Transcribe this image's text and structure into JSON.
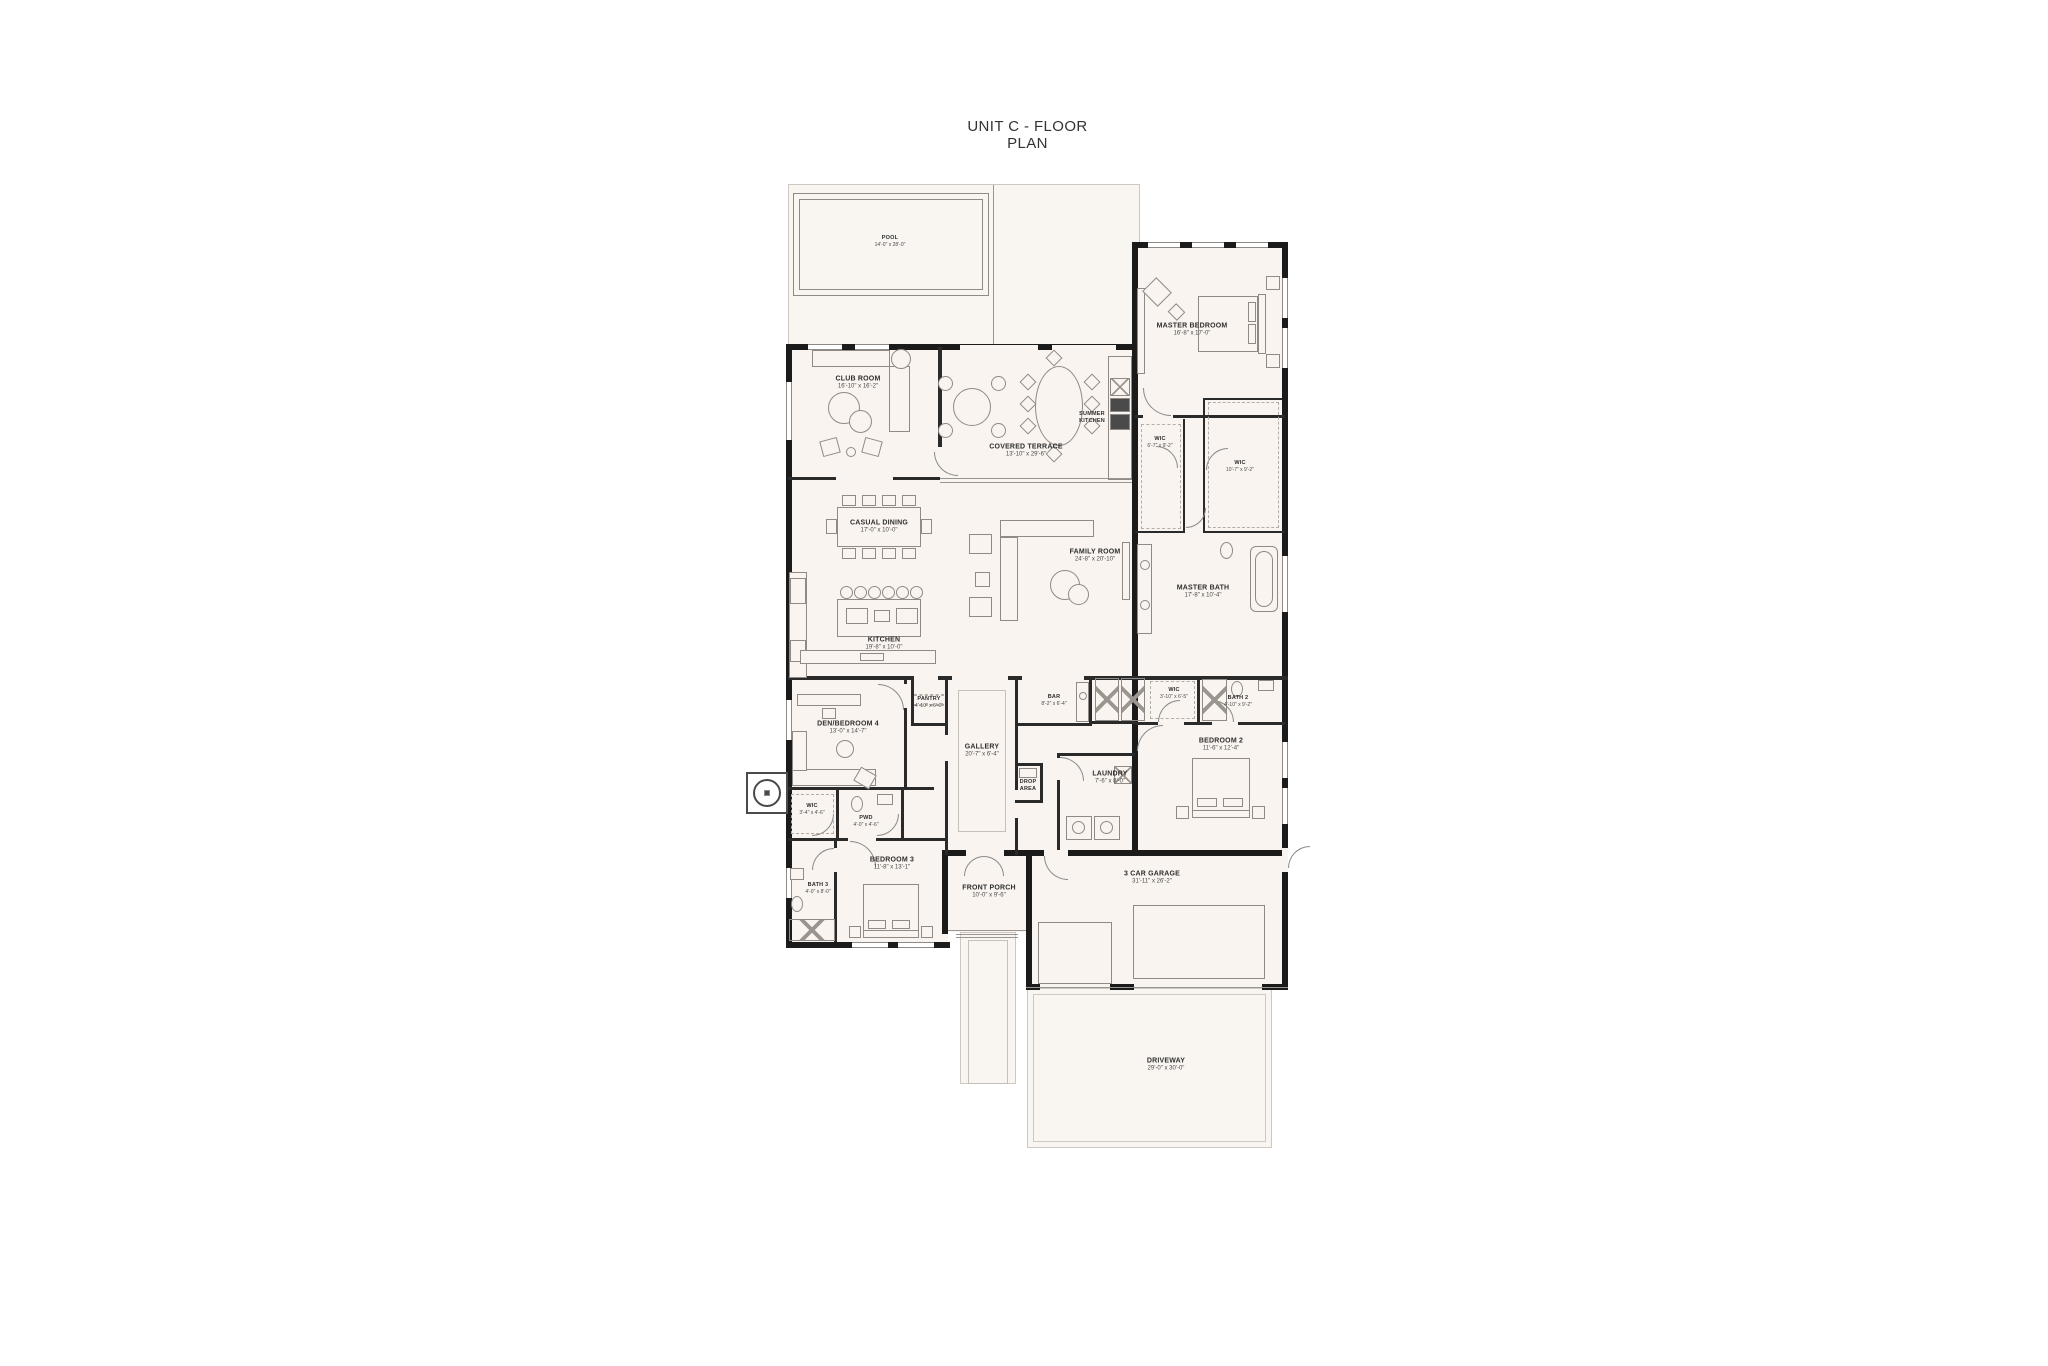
{
  "title": "UNIT C - FLOOR PLAN",
  "colors": {
    "wall": "#1b1b1b",
    "room_fill": "#f9f4ef",
    "furniture_line": "#8f8a85"
  },
  "rooms": {
    "pool": {
      "label": "POOL",
      "dims": "14'-0\" x 28'-0\""
    },
    "club_room": {
      "label": "CLUB ROOM",
      "dims": "16'-10\" x 16'-2\""
    },
    "covered_terrace": {
      "label": "COVERED TERRACE",
      "dims": "13'-10\" x 29'-6\""
    },
    "summer_kitchen": {
      "label": "SUMMER KITCHEN"
    },
    "master_bedroom": {
      "label": "MASTER BEDROOM",
      "dims": "16'-8\" x 17'-0\""
    },
    "wic_master_1": {
      "label": "WIC",
      "dims": "6'-7\" x 9'-2\""
    },
    "wic_master_2": {
      "label": "WIC",
      "dims": "10'-7\" x 9'-2\""
    },
    "master_bath": {
      "label": "MASTER BATH",
      "dims": "17'-8\" x 10'-4\""
    },
    "casual_dining": {
      "label": "CASUAL DINING",
      "dims": "17'-0\" x 10'-0\""
    },
    "kitchen": {
      "label": "KITCHEN",
      "dims": "19'-8\" x 10'-0\""
    },
    "family_room": {
      "label": "FAMILY ROOM",
      "dims": "24'-8\" x 20'-10\""
    },
    "den_bedroom_4": {
      "label": "DEN/BEDROOM 4",
      "dims": "13'-0\" x 14'-7\""
    },
    "pantry": {
      "label": "PANTRY",
      "dims": "4'-10\" x 6'-6\""
    },
    "gallery": {
      "label": "GALLERY",
      "dims": "20'-7\" x 6'-4\""
    },
    "bar": {
      "label": "BAR",
      "dims": "8'-2\" x 6'-4\""
    },
    "drop_area": {
      "label": "DROP AREA"
    },
    "wic_bedroom_2": {
      "label": "WIC",
      "dims": "3'-10\" x 6'-5\""
    },
    "bath_2": {
      "label": "BATH 2",
      "dims": "4'-10\" x 9'-2\""
    },
    "bedroom_2": {
      "label": "BEDROOM 2",
      "dims": "11'-6\" x 12'-4\""
    },
    "laundry": {
      "label": "LAUNDRY",
      "dims": "7'-6\" x 8'-0\""
    },
    "wic_bedroom_3": {
      "label": "WIC",
      "dims": "3'-4\" x 4'-6\""
    },
    "pwd": {
      "label": "PWD",
      "dims": "4'-0\" x 4'-6\""
    },
    "bath_3": {
      "label": "BATH 3",
      "dims": "4'-0\" x 8'-0\""
    },
    "bedroom_3": {
      "label": "BEDROOM 3",
      "dims": "11'-8\" x 13'-1\""
    },
    "front_porch": {
      "label": "FRONT PORCH",
      "dims": "10'-0\" x 9'-6\""
    },
    "garage": {
      "label": "3 CAR GARAGE",
      "dims": "31'-11\" x 26'-2\""
    },
    "driveway": {
      "label": "DRIVEWAY",
      "dims": "29'-0\" x 30'-0\""
    }
  }
}
